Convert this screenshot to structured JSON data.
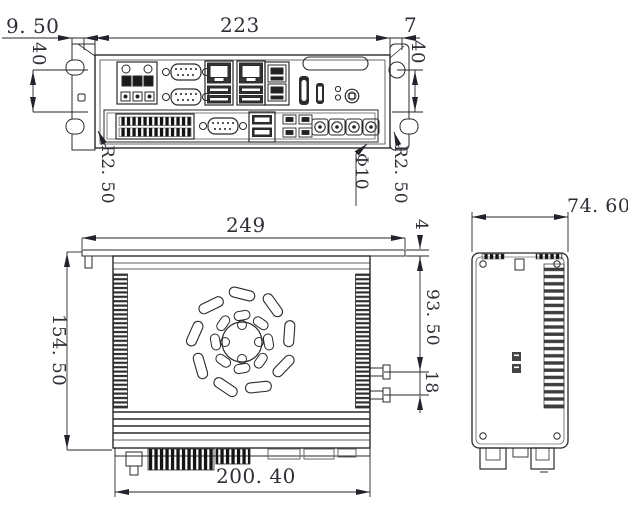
{
  "doc_type": "mechanical dimension drawing of fanless industrial embedded PC",
  "rear": {
    "bracket_offset": "9. 50",
    "body_width": "223",
    "ear_width": "7",
    "mount_height_left": "40",
    "mount_height_right": "40",
    "notch_radius_left": "R2. 50",
    "hole_diameter": "Φ10",
    "notch_radius_right": "R2. 50"
  },
  "plan": {
    "plate_width": "249",
    "plate_thickness": "4",
    "rear_to_antenna": "93. 50",
    "antenna_spacing": "18",
    "body_depth": "154. 50",
    "body_width": "200. 40"
  },
  "side": {
    "body_width": "74. 60"
  }
}
